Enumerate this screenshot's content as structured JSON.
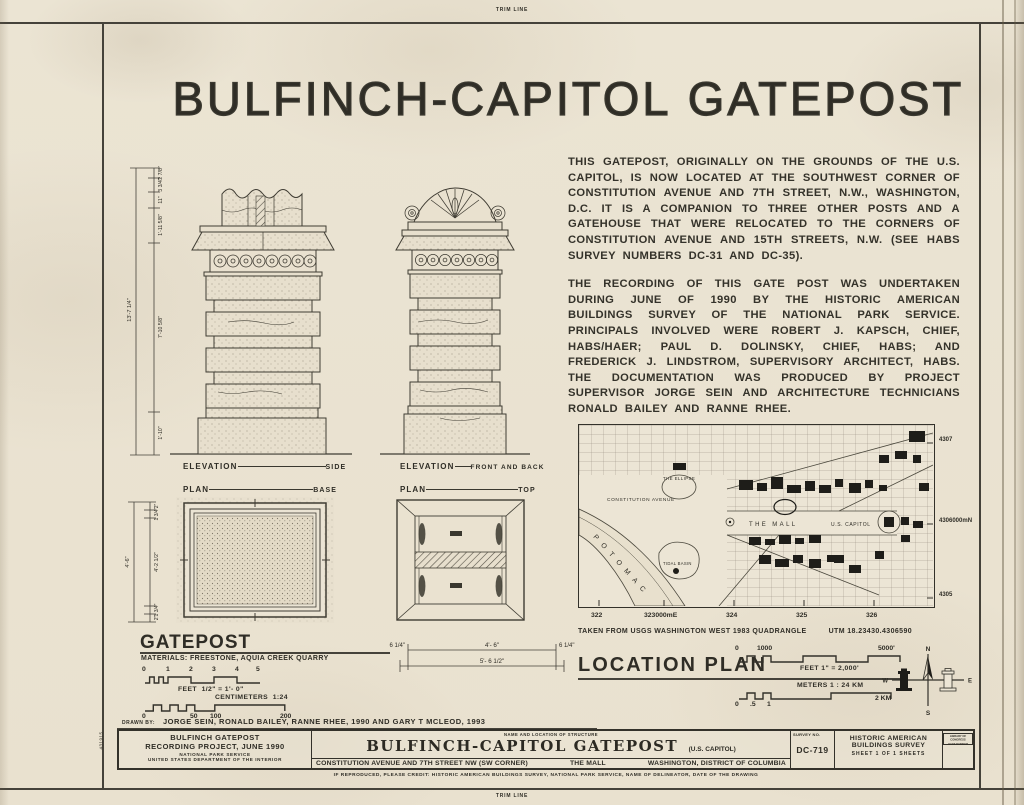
{
  "trim_line": "TRIM LINE",
  "margin_number": "431915",
  "title": {
    "left": "BULFINCH-CAPITOL",
    "right": "GATEPOST"
  },
  "narrative": {
    "p1": "THIS GATEPOST, ORIGINALLY ON THE GROUNDS OF THE U.S. CAPITOL, IS NOW LOCATED AT THE SOUTHWEST CORNER OF CONSTITUTION AVENUE AND 7TH STREET, N.W., WASHINGTON, D.C. IT IS A COMPANION TO THREE OTHER POSTS AND A GATEHOUSE THAT WERE RELOCATED TO THE CORNERS OF CONSTITUTION AVENUE AND 15TH STREETS, N.W. (SEE HABS SURVEY NUMBERS DC-31 AND DC-35).",
    "p2": "THE RECORDING OF THIS GATE POST WAS UNDERTAKEN DURING JUNE OF 1990 BY THE HISTORIC AMERICAN BUILDINGS SURVEY OF THE NATIONAL PARK SERVICE. PRINCIPALS INVOLVED WERE ROBERT J. KAPSCH, CHIEF, HABS/HAER; PAUL D. DOLINSKY, CHIEF, HABS; AND FREDERICK J. LINDSTROM, SUPERVISORY ARCHITECT, HABS. THE DOCUMENTATION WAS PRODUCED BY PROJECT SUPERVISOR JORGE SEIN AND ARCHITECTURE TECHNICIANS RONALD BAILEY AND RANNE RHEE."
  },
  "drawings": {
    "elevation_side": {
      "label": "ELEVATION",
      "value": "SIDE"
    },
    "plan_base": {
      "label": "PLAN",
      "value": "BASE"
    },
    "elevation_front": {
      "label": "ELEVATION",
      "value": "FRONT AND BACK"
    },
    "plan_top": {
      "label": "PLAN",
      "value": "TOP"
    },
    "side_dims": {
      "overall": "13'-7 1/4\"",
      "segments": [
        "2 7/8\"",
        "3 3/4\"",
        "11\"",
        "1'-11 5/8\"",
        "7'-10 5/8\"",
        "1'-10\""
      ]
    },
    "base_dims": {
      "overall": "4'-6\"",
      "segments": [
        "2\"",
        "1 3/4\"",
        "4'-2 1/2\"",
        "1 3/4\"",
        "2\""
      ]
    },
    "top_dims": {
      "left": "6 1/4\"",
      "span": "4'- 6\"",
      "right": "6 1/4\"",
      "overall": "5'- 6 1/2\""
    }
  },
  "gatepost_section": {
    "title": "GATEPOST",
    "materials": "MATERIALS: FREESTONE, AQUIA CREEK QUARRY",
    "feet_ticks": [
      "0",
      "1",
      "2",
      "3",
      "4",
      "5"
    ],
    "feet_label": "FEET",
    "feet_scale": "1/2\" = 1'- 0\"",
    "cm_label": "CENTIMETERS",
    "cm_ratio": "1:24",
    "cm_ticks": [
      "0",
      "50",
      "100",
      "200"
    ]
  },
  "map": {
    "labels": {
      "constitution": "CONSTITUTION AVENUE",
      "ellipse": "THE ELLIPSE",
      "mall": "THE MALL",
      "capitol": "U.S. CAPITOL",
      "tidal": "TIDAL BASIN",
      "potomac": "POTOMAC"
    },
    "x_ticks": [
      "322",
      "323000mE",
      "324",
      "325",
      "326"
    ],
    "y_ticks": [
      "4307",
      "4306000mN",
      "4305"
    ],
    "caption": "TAKEN FROM USGS WASHINGTON WEST 1983 QUADRANGLE",
    "utm": "UTM 18.23430.4306590"
  },
  "location_plan": {
    "title": "LOCATION PLAN",
    "feet_zero": "0",
    "feet_mid": "1000",
    "feet_end": "5000'",
    "feet_label": "FEET 1\" = 2,000'",
    "meters_label": "METERS 1 : 24 KM",
    "km_zero": "0",
    "km_half": ".5",
    "km_one": "1",
    "km_end": "2 KM",
    "compass": {
      "n": "N",
      "s": "S",
      "e": "E",
      "w": "W"
    }
  },
  "titleblock": {
    "drawn_by_label": "DRAWN BY:",
    "drawn_by": "JORGE SEIN, RONALD BAILEY, RANNE RHEE, 1990 AND GARY T MCLEOD, 1993",
    "project_line1": "BULFINCH GATEPOST",
    "project_line2": "RECORDING PROJECT, JUNE 1990",
    "agency1": "NATIONAL PARK SERVICE",
    "agency2": "UNITED STATES DEPARTMENT OF THE INTERIOR",
    "name_header": "NAME AND LOCATION OF STRUCTURE",
    "name": "BULFINCH-CAPITOL GATEPOST",
    "name_suffix": "(U.S. CAPITOL)",
    "address": "CONSTITUTION AVENUE AND 7TH STREET NW (SW CORNER)",
    "area": "THE MALL",
    "city": "WASHINGTON, DISTRICT OF COLUMBIA",
    "survey_label": "SURVEY NO.",
    "survey_no": "DC-719",
    "habs_line1": "HISTORIC AMERICAN",
    "habs_line2": "BUILDINGS SURVEY",
    "sheet_line": "SHEET 1 OF 1 SHEETS",
    "corner_line1": "LIBRARY OF CONGRESS",
    "corner_line2": "HABS NUMBER",
    "credit": "IF REPRODUCED, PLEASE CREDIT: HISTORIC AMERICAN BUILDINGS SURVEY, NATIONAL PARK SERVICE, NAME OF DELINEATOR, DATE OF THE DRAWING"
  },
  "colors": {
    "paper": "#ebe4d3",
    "ink": "#2f2d26"
  }
}
